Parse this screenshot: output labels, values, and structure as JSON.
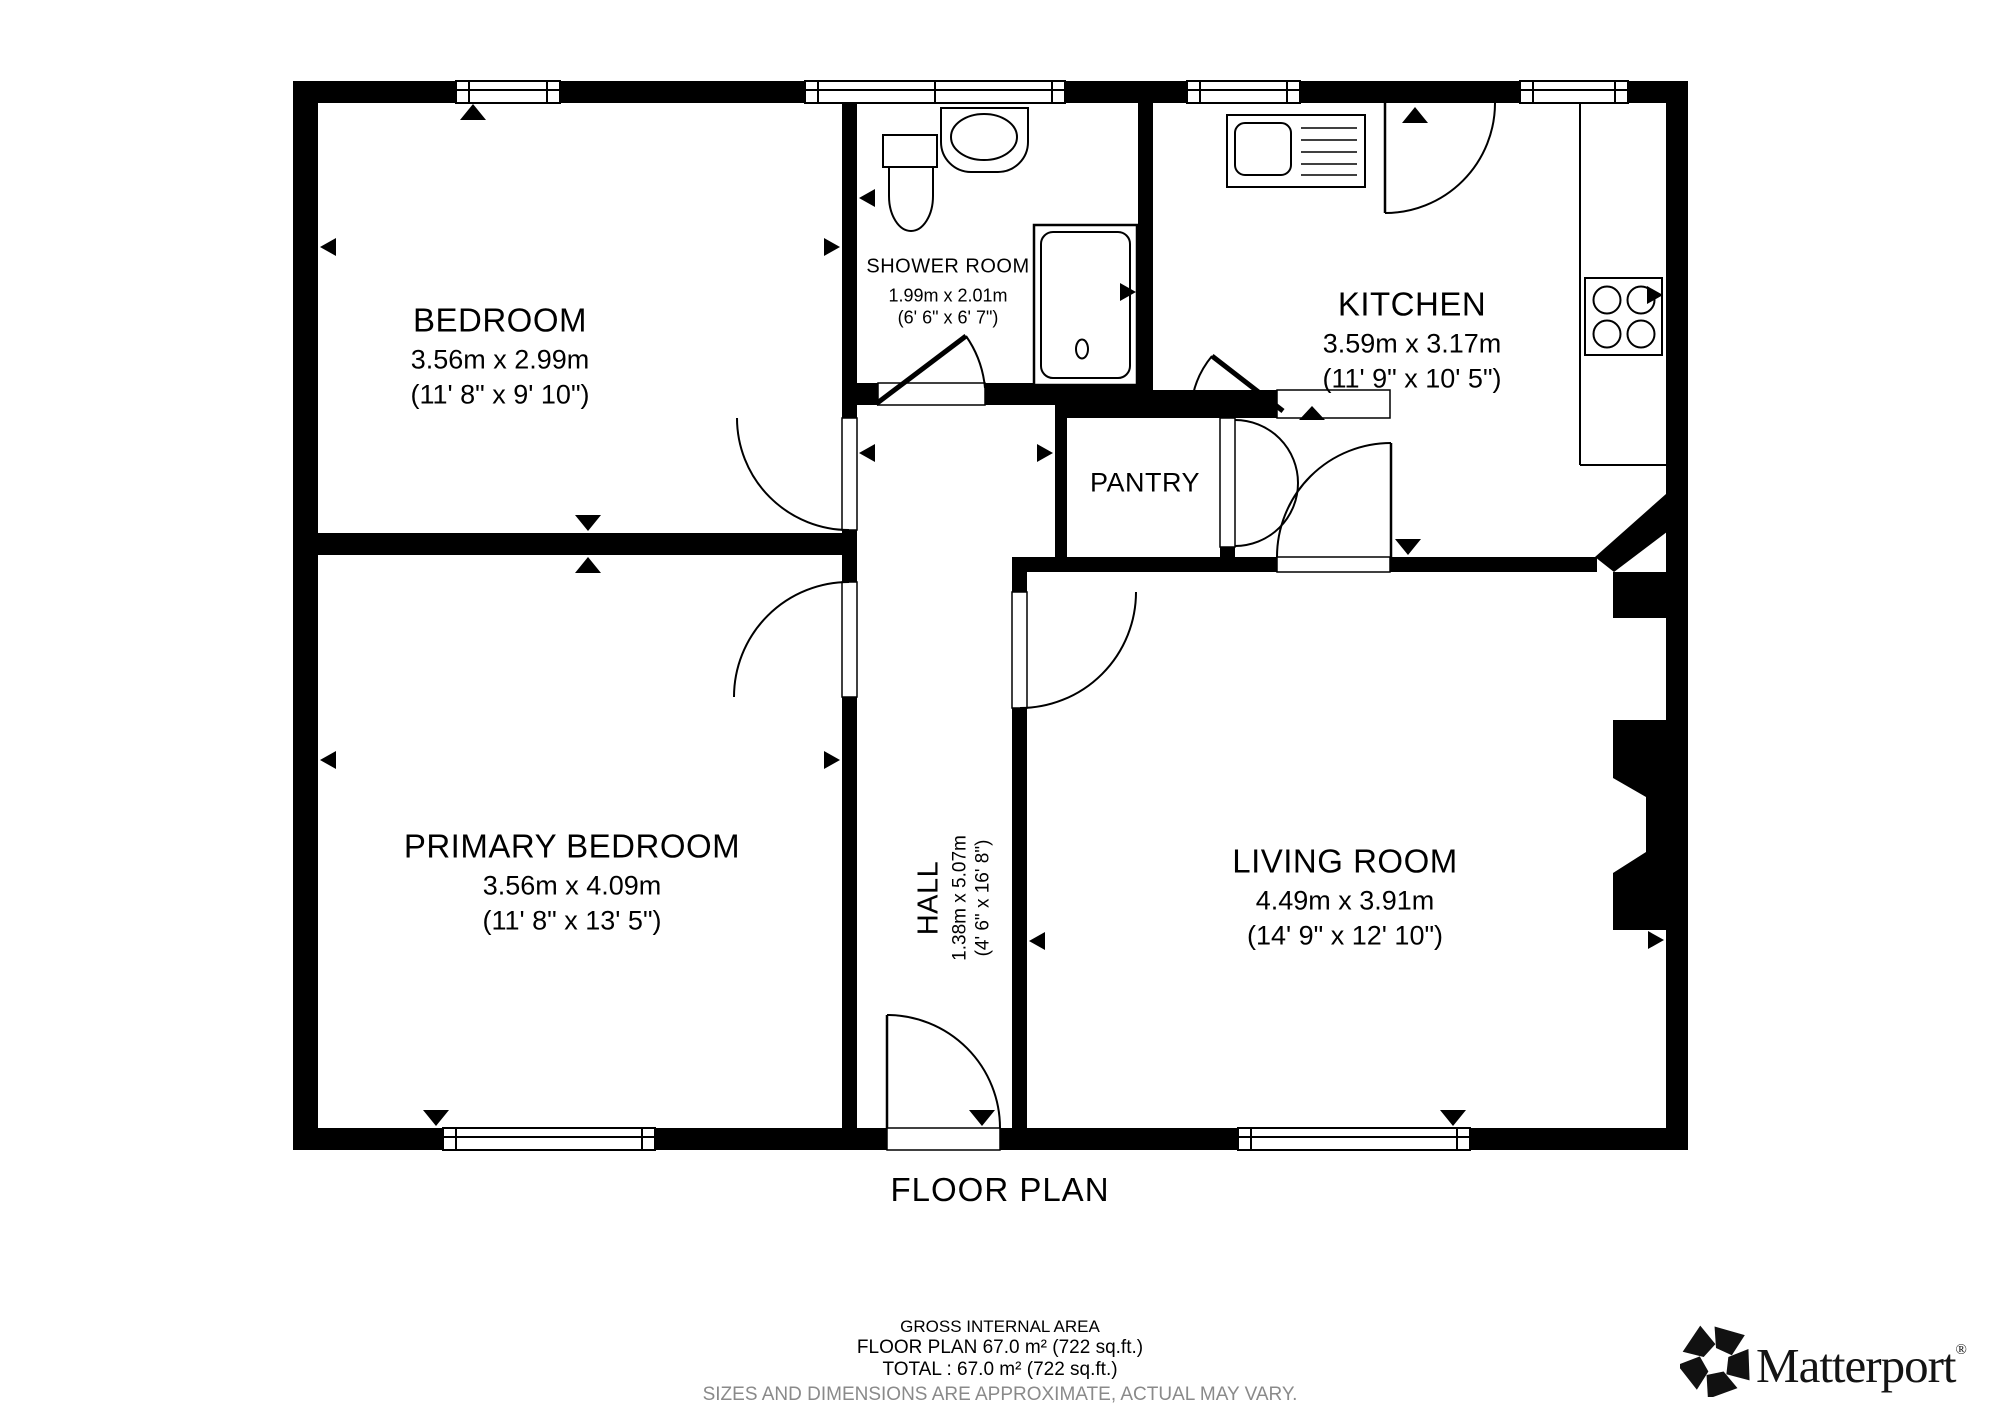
{
  "title": "FLOOR PLAN",
  "rooms": {
    "bedroom": {
      "name": "BEDROOM",
      "metric": "3.56m x 2.99m",
      "imperial": "(11' 8\" x 9' 10\")"
    },
    "shower_room": {
      "name": "SHOWER ROOM",
      "metric": "1.99m x 2.01m",
      "imperial": "(6' 6\" x 6' 7\")"
    },
    "kitchen": {
      "name": "KITCHEN",
      "metric": "3.59m x 3.17m",
      "imperial": "(11' 9\" x 10' 5\")"
    },
    "pantry": {
      "name": "PANTRY"
    },
    "primary_bedroom": {
      "name": "PRIMARY BEDROOM",
      "metric": "3.56m x 4.09m",
      "imperial": "(11' 8\" x 13' 5\")"
    },
    "living_room": {
      "name": "LIVING ROOM",
      "metric": "4.49m x 3.91m",
      "imperial": "(14' 9\" x 12' 10\")"
    },
    "hall": {
      "name": "HALL",
      "metric": "1.38m x 5.07m",
      "imperial": "(4' 6\" x 16' 8\")"
    }
  },
  "footer": {
    "line1": "GROSS INTERNAL AREA",
    "line2": "FLOOR PLAN 67.0 m² (722 sq.ft.)",
    "line3": "TOTAL :  67.0 m² (722 sq.ft.)",
    "line4": "SIZES AND DIMENSIONS ARE APPROXIMATE, ACTUAL MAY VARY."
  },
  "brand": {
    "name": "Matterport",
    "registered": "®"
  },
  "colors": {
    "wall": "#000000",
    "paper": "#ffffff",
    "footer_note": "#8a8a8a"
  }
}
